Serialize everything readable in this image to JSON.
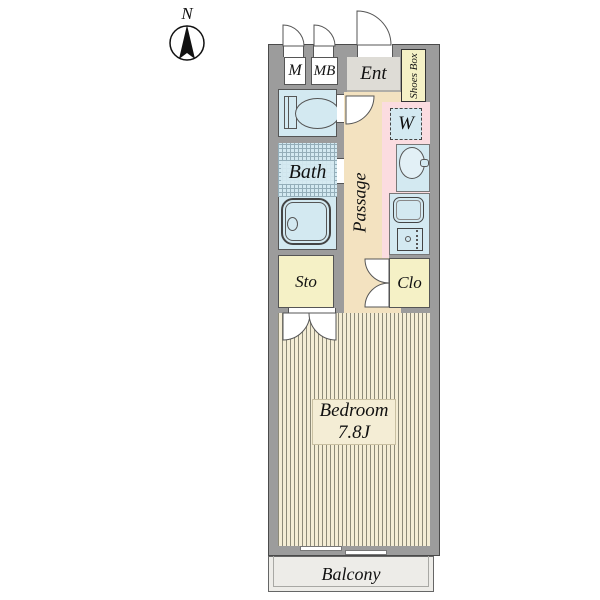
{
  "title": "Apartment floor plan",
  "compass": {
    "label": "N"
  },
  "rooms": {
    "m": {
      "label": "M"
    },
    "mb": {
      "label": "MB"
    },
    "ent": {
      "label": "Ent"
    },
    "shoes_box": {
      "label": "Shoes Box"
    },
    "washer": {
      "label": "W"
    },
    "bath": {
      "label": "Bath"
    },
    "passage": {
      "label": "Passage"
    },
    "sto": {
      "label": "Sto"
    },
    "clo": {
      "label": "Clo"
    },
    "bedroom": {
      "label": "Bedroom",
      "size": "7.8J"
    },
    "balcony": {
      "label": "Balcony"
    }
  },
  "palette": {
    "wall": "#9c9c9c",
    "wet_rooms_blue": "#d3e9f1",
    "passage_beige": "#f3e2c0",
    "kitchen_pink": "#fbdce0",
    "storage_yellow": "#f5f1c6",
    "entrance_gray": "#dedcd6",
    "bedroom_floor": "#f4edd5",
    "balcony_gray": "#edece8"
  }
}
